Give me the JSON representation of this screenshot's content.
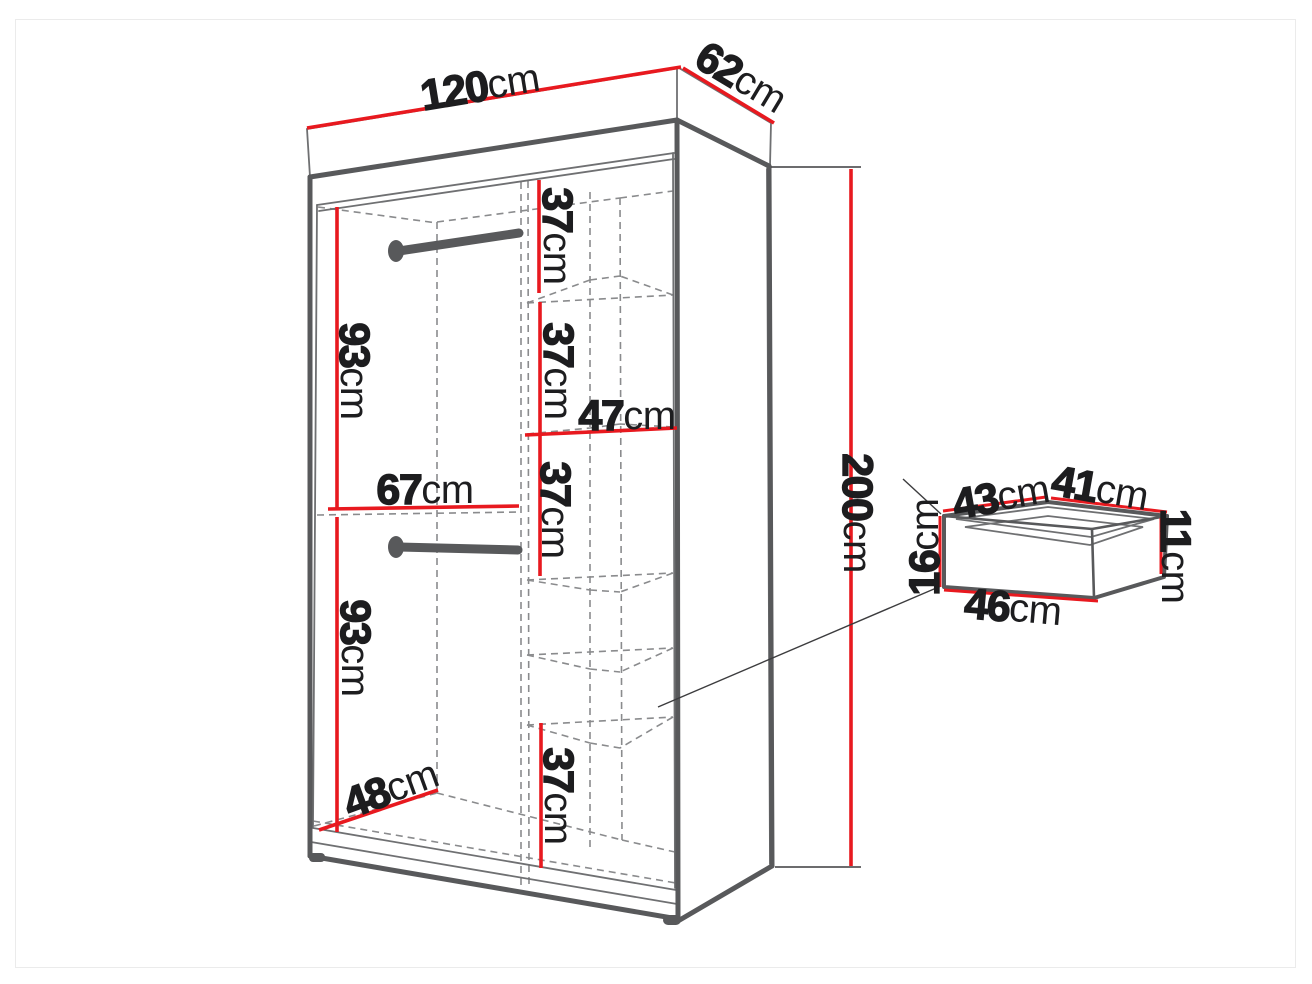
{
  "diagram_type": "wardrobe-dimension-diagram",
  "colors": {
    "dimension_red": "#e8191f",
    "outline_gray": "#58595b",
    "dashed_gray": "#8a8b8d",
    "label_black": "#1d1d1f",
    "background": "#ffffff"
  },
  "wardrobe": {
    "width": {
      "value": "120",
      "unit": "cm"
    },
    "depth": {
      "value": "62",
      "unit": "cm"
    },
    "height": {
      "value": "200",
      "unit": "cm"
    },
    "hanging_upper": {
      "value": "93",
      "unit": "cm"
    },
    "hanging_lower": {
      "value": "93",
      "unit": "cm"
    },
    "left_section_width": {
      "value": "67",
      "unit": "cm"
    },
    "shelf_width": {
      "value": "47",
      "unit": "cm"
    },
    "interior_depth": {
      "value": "48",
      "unit": "cm"
    },
    "shelf_section_top": {
      "value": "37",
      "unit": "cm"
    },
    "shelf_section_upper": {
      "value": "37",
      "unit": "cm"
    },
    "shelf_section_middle": {
      "value": "37",
      "unit": "cm"
    },
    "shelf_section_bottom": {
      "value": "37",
      "unit": "cm"
    }
  },
  "drawer": {
    "top_left_edge": {
      "value": "43",
      "unit": "cm"
    },
    "top_right_edge": {
      "value": "41",
      "unit": "cm"
    },
    "front_height": {
      "value": "16",
      "unit": "cm"
    },
    "back_height": {
      "value": "11",
      "unit": "cm"
    },
    "bottom_front_edge": {
      "value": "46",
      "unit": "cm"
    }
  }
}
